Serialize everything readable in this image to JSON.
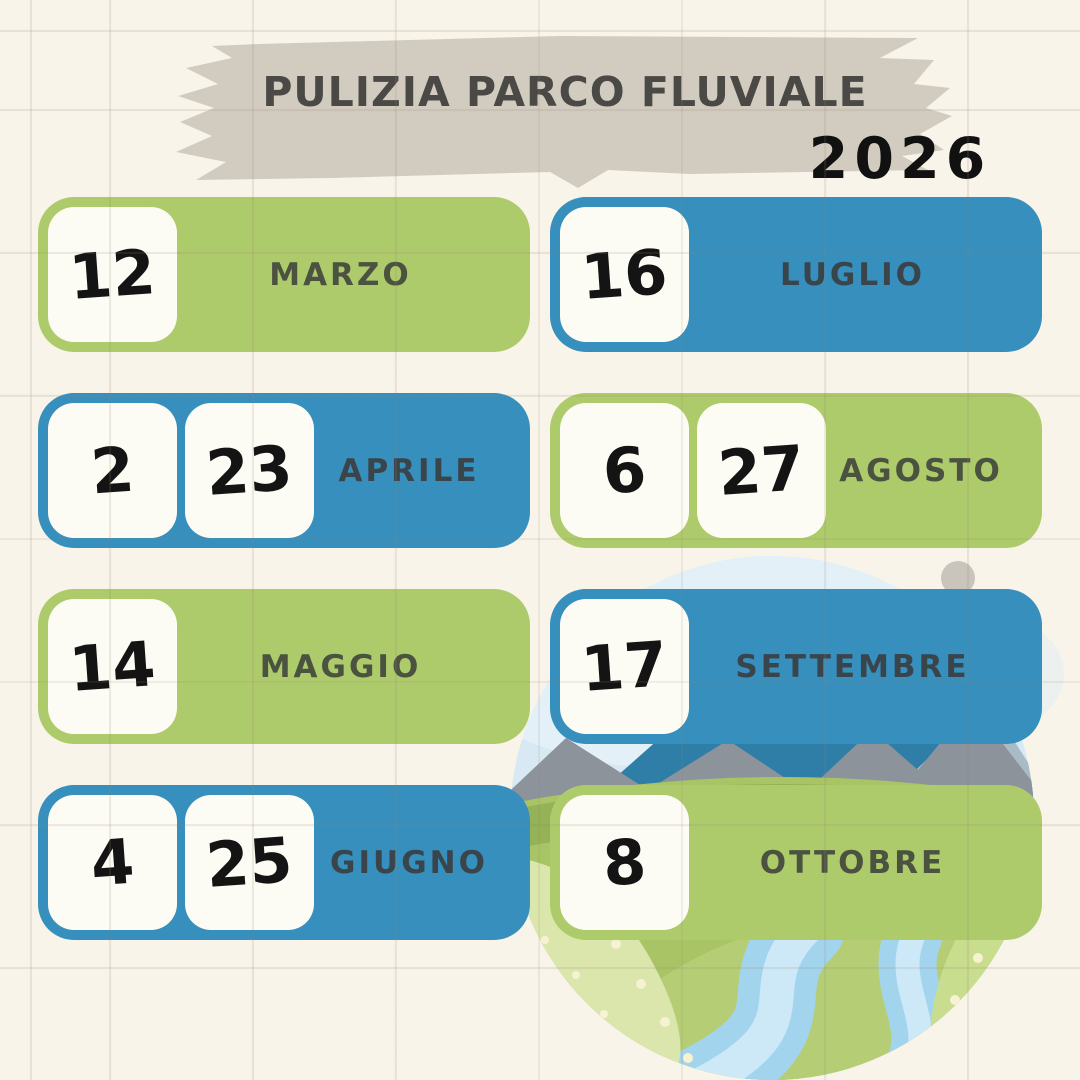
{
  "poster": {
    "title": "PULIZIA PARCO FLUVIALE",
    "year": "2026"
  },
  "colors": {
    "cream": "#f8f4ea",
    "banner": "#d2ccc0",
    "ink": "#4b4945",
    "year_ink": "#111111",
    "green": "#aecb6b",
    "blue": "#368fbc",
    "paper": "#fdfcf4",
    "number_ink": "#141414",
    "month_on_green": "#4b5340",
    "month_on_blue": "#3a444b",
    "grid_line": "#e9e1d9",
    "sky": "#d8e9f3",
    "mountain_blue": "#2f7ea8",
    "mountain_grey": "#8c939a",
    "hill_green": "#a8c465",
    "river_blue": "#a3d4ee"
  },
  "schedule": [
    {
      "month": "MARZO",
      "dates": [
        "12"
      ],
      "color": "green"
    },
    {
      "month": "LUGLIO",
      "dates": [
        "16"
      ],
      "color": "blue"
    },
    {
      "month": "APRILE",
      "dates": [
        "2",
        "23"
      ],
      "color": "blue"
    },
    {
      "month": "AGOSTO",
      "dates": [
        "6",
        "27"
      ],
      "color": "green"
    },
    {
      "month": "MAGGIO",
      "dates": [
        "14"
      ],
      "color": "green"
    },
    {
      "month": "SETTEMBRE",
      "dates": [
        "17"
      ],
      "color": "blue"
    },
    {
      "month": "GIUGNO",
      "dates": [
        "4",
        "25"
      ],
      "color": "blue"
    },
    {
      "month": "OTTOBRE",
      "dates": [
        "8"
      ],
      "color": "green"
    }
  ],
  "illustration": {
    "description": "circular river park landscape with mountains and winding river"
  }
}
